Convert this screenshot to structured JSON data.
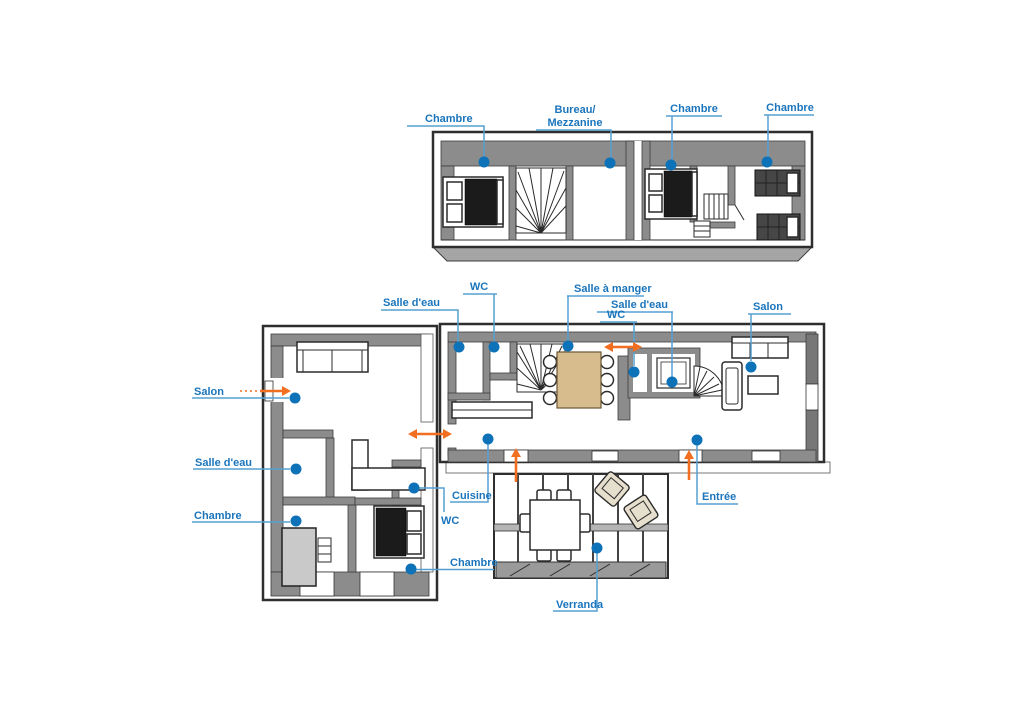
{
  "colors": {
    "label_blue": "#1b75bc",
    "leader_blue": "#559fd2",
    "dot_blue": "#0d72b8",
    "arrow_orange": "#f26f21",
    "wall_gray": "#8c8c8c",
    "wall_dark": "#2e2e2e",
    "wood": "#d7bd8e",
    "chair_beige": "#e7dfcd"
  },
  "floor_plans": {
    "upper": {
      "labels": {
        "chambre_left": "Chambre",
        "bureau_line1": "Bureau/",
        "bureau_line2": "Mezzanine",
        "chambre_mid": "Chambre",
        "chambre_right": "Chambre"
      }
    },
    "ground": {
      "labels": {
        "salle_deau_top": "Salle d'eau",
        "wc_top": "WC",
        "salle_a_manger": "Salle à manger",
        "salle_deau_right": "Salle d'eau",
        "wc_right": "WC",
        "salon_right": "Salon",
        "salon_left": "Salon",
        "salle_deau_left": "Salle d'eau",
        "chambre_left": "Chambre",
        "cuisine": "Cuisine",
        "wc_left": "WC",
        "chambre_bottom": "Chambre",
        "entree": "Entrée",
        "verranda": "Verranda"
      }
    }
  }
}
